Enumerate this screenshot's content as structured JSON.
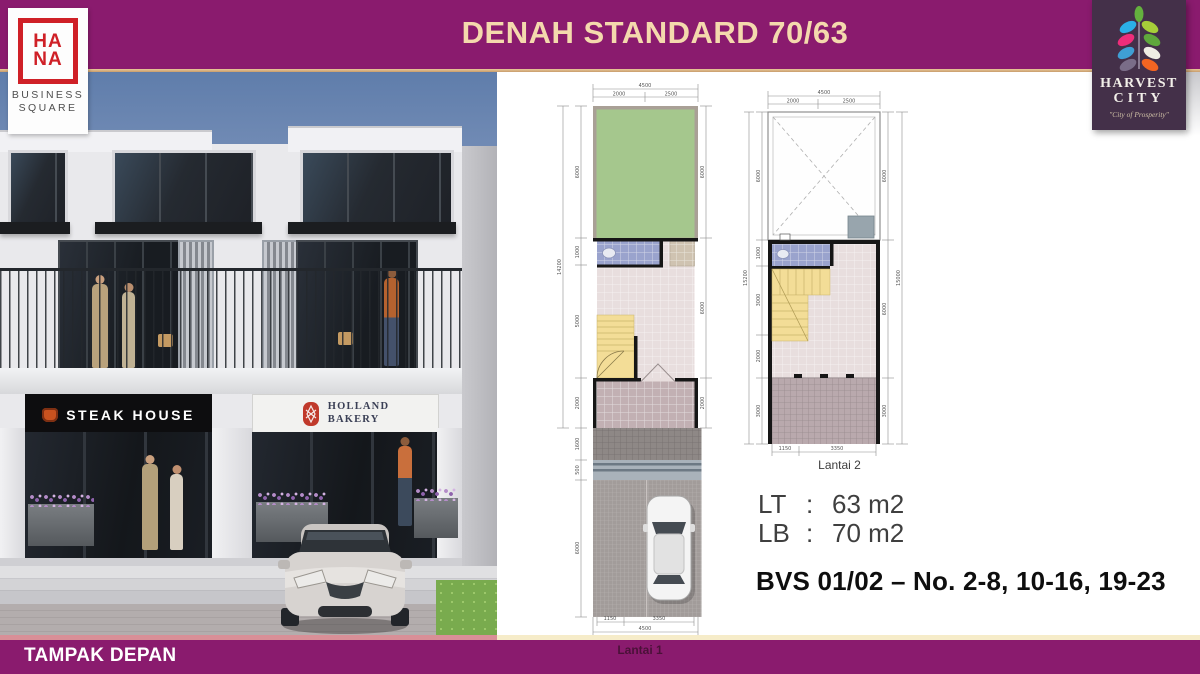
{
  "colors": {
    "header_purple": "#8a1b6e",
    "gold_line": "#d9b488",
    "title_text": "#f4d9ad",
    "hana_red": "#cf2027",
    "harvest_bg": "#443049",
    "garden_green": "#a5c78d",
    "stairs_yellow": "#f3dd97",
    "bathroom_blue": "#9aa3cd"
  },
  "header": {
    "title": "DENAH STANDARD 70/63"
  },
  "hana_logo": {
    "line1": "HA",
    "line2": "NA",
    "sub1": "BUSINESS",
    "sub2": "SQUARE"
  },
  "harvest_logo": {
    "name1": "HARVEST",
    "name2": "CITY",
    "tagline": "\"City of Prosperity\"",
    "leaf_colors": [
      "#64b13e",
      "#2bb0e8",
      "#a6ce39",
      "#ee2d7a",
      "#5fa73c",
      "#3f9fd4",
      "#efece4",
      "#7a6d88",
      "#f26522"
    ]
  },
  "photo": {
    "sign_left": "STEAK HOUSE",
    "sign_right_1": "HOLLAND",
    "sign_right_2": "BAKERY"
  },
  "plans": {
    "lantai1": {
      "label": "Lantai 1",
      "dims": {
        "top_total": "4500",
        "top_a": "2000",
        "top_b": "2500",
        "left_total": "14200",
        "left_a": "6000",
        "left_b": "1000",
        "left_c": "5000",
        "left_d": "2000",
        "left_e": "1600",
        "left_f": "500",
        "left_g": "6000",
        "right_a": "6000",
        "right_b": "6000",
        "right_c": "2000",
        "bottom_a": "1150",
        "bottom_b": "3350",
        "bottom_total": "4500"
      }
    },
    "lantai2": {
      "label": "Lantai 2",
      "dims": {
        "top_total": "4500",
        "top_a": "2000",
        "top_b": "2500",
        "left_total": "15200",
        "left_a": "6000",
        "left_b": "1000",
        "left_c": "3000",
        "left_d": "2000",
        "left_e": "3000",
        "right_total": "15000",
        "right_a": "6000",
        "right_b": "6000",
        "right_c": "3000",
        "bottom_a": "1150",
        "bottom_b": "3350"
      }
    }
  },
  "specs": {
    "lt_label": "LT",
    "lt_colon": ":",
    "lt_value": "63 m2",
    "lb_label": "LB",
    "lb_colon": ":",
    "lb_value": "70 m2"
  },
  "unit_info": "BVS 01/02 – No. 2-8, 10-16, 19-23",
  "footer": {
    "label": "TAMPAK DEPAN"
  }
}
